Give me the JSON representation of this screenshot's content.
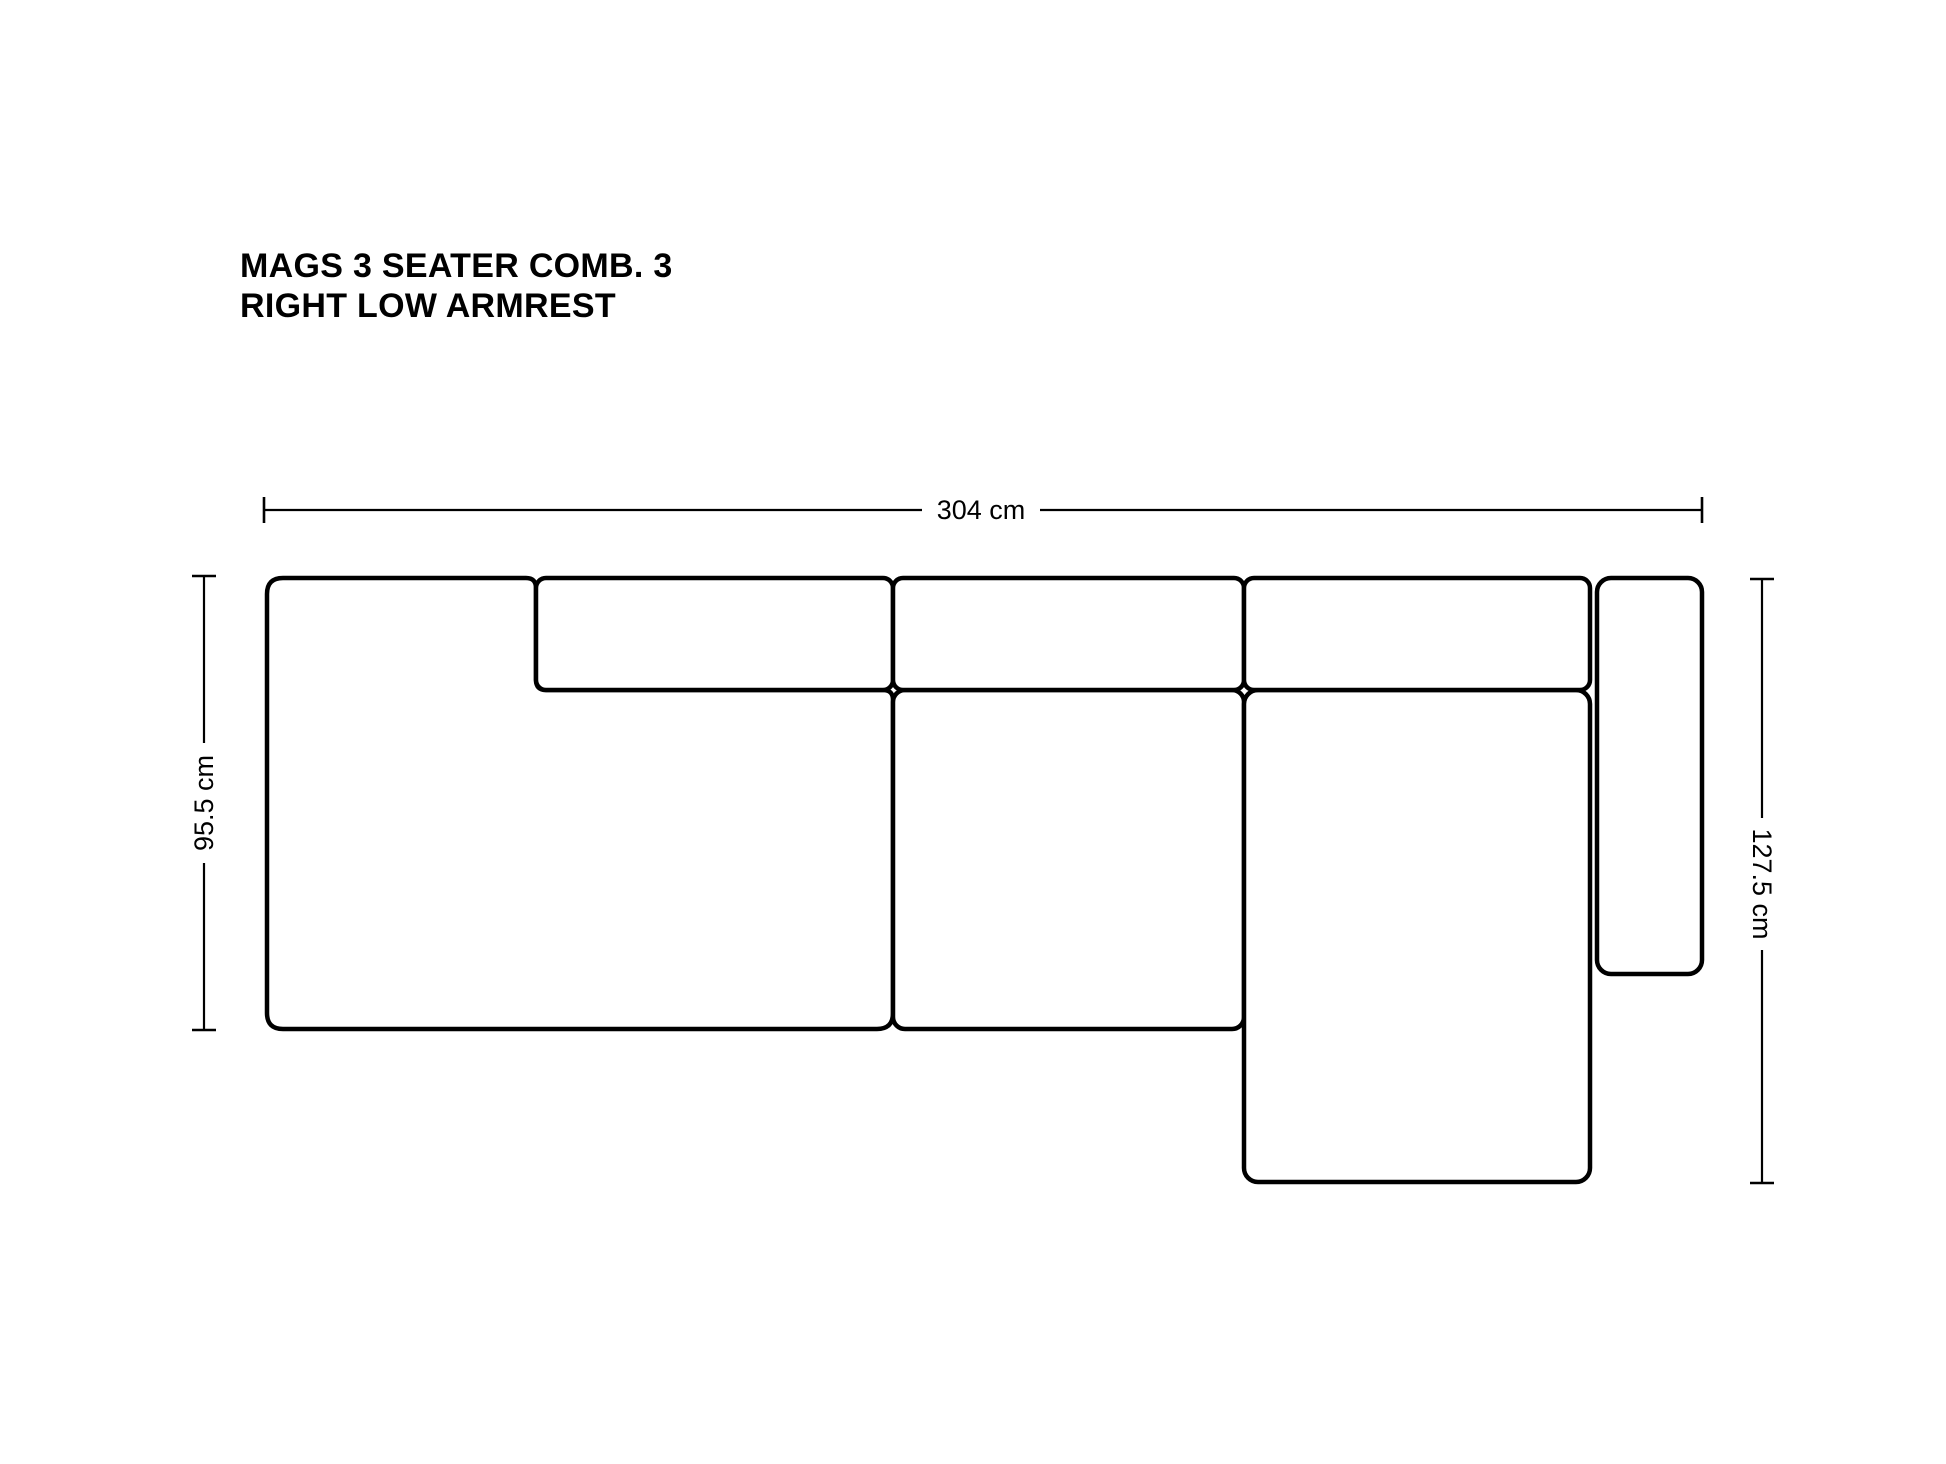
{
  "title": {
    "line1": "MAGS 3 SEATER COMB. 3",
    "line2": "RIGHT LOW ARMREST"
  },
  "dimensions": {
    "width_label": "304 cm",
    "left_height_label": "95.5 cm",
    "right_height_label": "127.5 cm"
  },
  "colors": {
    "line": "#000000",
    "background": "#ffffff"
  }
}
